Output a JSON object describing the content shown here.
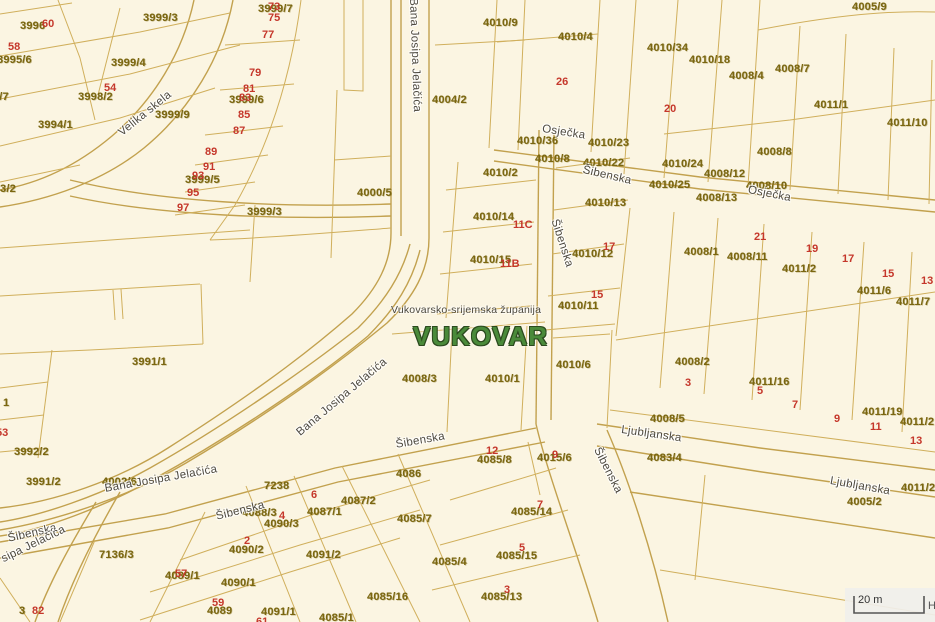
{
  "map": {
    "city_label": "VUKOVAR",
    "county_label": "Vukovarsko-srijemska županija",
    "scale_bar": {
      "label": "20 m",
      "attribution": "H"
    },
    "colors": {
      "background": "#fbf5e2",
      "boundary_line": "#c2a14e",
      "parcel_line": "#d0af5c",
      "parcel_number_text": "#7a6610",
      "house_number_text": "#c5372b",
      "street_name_text": "#4e4a40",
      "city_name_text": "#4a8a3a"
    },
    "legend": {
      "p": "parcel-number",
      "h": "house-number",
      "s": "street-name"
    },
    "labels": [
      {
        "t": "3996",
        "x": 20,
        "y": 21,
        "k": "p"
      },
      {
        "t": "60",
        "x": 42,
        "y": 19,
        "k": "h"
      },
      {
        "t": "3999/3",
        "x": 143,
        "y": 13,
        "k": "p"
      },
      {
        "t": "3999/7",
        "x": 258,
        "y": 4,
        "k": "p"
      },
      {
        "t": "73",
        "x": 268,
        "y": 2,
        "k": "h"
      },
      {
        "t": "75",
        "x": 268,
        "y": 13,
        "k": "h"
      },
      {
        "t": "77",
        "x": 262,
        "y": 30,
        "k": "h"
      },
      {
        "t": "3995/6",
        "x": -3,
        "y": 55,
        "k": "p"
      },
      {
        "t": "3999/4",
        "x": 111,
        "y": 58,
        "k": "p"
      },
      {
        "t": "58",
        "x": 8,
        "y": 42,
        "k": "h"
      },
      {
        "t": "54",
        "x": 104,
        "y": 83,
        "k": "h"
      },
      {
        "t": "3998/2",
        "x": 78,
        "y": 92,
        "k": "p"
      },
      {
        "t": "3998/7",
        "x": -26,
        "y": 92,
        "k": "p"
      },
      {
        "t": "79",
        "x": 249,
        "y": 68,
        "k": "h"
      },
      {
        "t": "81",
        "x": 243,
        "y": 84,
        "k": "h"
      },
      {
        "t": "3999/6",
        "x": 229,
        "y": 95,
        "k": "p"
      },
      {
        "t": "83",
        "x": 239,
        "y": 93,
        "k": "h"
      },
      {
        "t": "85",
        "x": 238,
        "y": 110,
        "k": "h"
      },
      {
        "t": "87",
        "x": 233,
        "y": 126,
        "k": "h"
      },
      {
        "t": "3994/1",
        "x": 38,
        "y": 120,
        "k": "p"
      },
      {
        "t": "3999/9",
        "x": 155,
        "y": 110,
        "k": "p"
      },
      {
        "t": "89",
        "x": 205,
        "y": 147,
        "k": "h"
      },
      {
        "t": "91",
        "x": 203,
        "y": 162,
        "k": "h"
      },
      {
        "t": "3999/5",
        "x": 185,
        "y": 175,
        "k": "p"
      },
      {
        "t": "93",
        "x": 192,
        "y": 171,
        "k": "h"
      },
      {
        "t": "95",
        "x": 187,
        "y": 188,
        "k": "h"
      },
      {
        "t": "97",
        "x": 177,
        "y": 203,
        "k": "h"
      },
      {
        "t": "3/2",
        "x": 0,
        "y": 184,
        "k": "p"
      },
      {
        "t": "3999/3",
        "x": 247,
        "y": 207,
        "k": "p"
      },
      {
        "t": "4000/5",
        "x": 357,
        "y": 188,
        "k": "p"
      },
      {
        "t": "4010/9",
        "x": 483,
        "y": 18,
        "k": "p"
      },
      {
        "t": "4004/2",
        "x": 432,
        "y": 95,
        "k": "p"
      },
      {
        "t": "4010/4",
        "x": 558,
        "y": 32,
        "k": "p"
      },
      {
        "t": "26",
        "x": 556,
        "y": 77,
        "k": "h"
      },
      {
        "t": "4010/36",
        "x": 517,
        "y": 136,
        "k": "p"
      },
      {
        "t": "4010/23",
        "x": 588,
        "y": 138,
        "k": "p"
      },
      {
        "t": "4010/8",
        "x": 535,
        "y": 154,
        "k": "p"
      },
      {
        "t": "4010/22",
        "x": 583,
        "y": 158,
        "k": "p"
      },
      {
        "t": "4010/2",
        "x": 483,
        "y": 168,
        "k": "p"
      },
      {
        "t": "4010/13",
        "x": 585,
        "y": 198,
        "k": "p"
      },
      {
        "t": "4010/14",
        "x": 473,
        "y": 212,
        "k": "p"
      },
      {
        "t": "11C",
        "x": 513,
        "y": 220,
        "k": "h"
      },
      {
        "t": "4010/15",
        "x": 470,
        "y": 255,
        "k": "p"
      },
      {
        "t": "11B",
        "x": 500,
        "y": 259,
        "k": "h"
      },
      {
        "t": "4010/12",
        "x": 572,
        "y": 249,
        "k": "p"
      },
      {
        "t": "17",
        "x": 603,
        "y": 242,
        "k": "h"
      },
      {
        "t": "4010/11",
        "x": 558,
        "y": 301,
        "k": "p"
      },
      {
        "t": "15",
        "x": 591,
        "y": 290,
        "k": "h"
      },
      {
        "t": "4008/3",
        "x": 402,
        "y": 374,
        "k": "p"
      },
      {
        "t": "4010/1",
        "x": 485,
        "y": 374,
        "k": "p"
      },
      {
        "t": "4010/6",
        "x": 556,
        "y": 360,
        "k": "p"
      },
      {
        "t": "3991/1",
        "x": 132,
        "y": 357,
        "k": "p"
      },
      {
        "t": "1",
        "x": 3,
        "y": 398,
        "k": "p"
      },
      {
        "t": "53",
        "x": -4,
        "y": 428,
        "k": "h"
      },
      {
        "t": "3992/2",
        "x": 14,
        "y": 447,
        "k": "p"
      },
      {
        "t": "3991/2",
        "x": 26,
        "y": 477,
        "k": "p"
      },
      {
        "t": "4002/6",
        "x": 102,
        "y": 477,
        "k": "p"
      },
      {
        "t": "7238",
        "x": 264,
        "y": 481,
        "k": "p"
      },
      {
        "t": "7136/3",
        "x": 99,
        "y": 550,
        "k": "p"
      },
      {
        "t": "3",
        "x": 19,
        "y": 606,
        "k": "p"
      },
      {
        "t": "82",
        "x": 32,
        "y": 606,
        "k": "h"
      },
      {
        "t": "4086",
        "x": 396,
        "y": 469,
        "k": "p"
      },
      {
        "t": "6",
        "x": 311,
        "y": 490,
        "k": "h"
      },
      {
        "t": "4087/2",
        "x": 341,
        "y": 496,
        "k": "p"
      },
      {
        "t": "4087/1",
        "x": 307,
        "y": 507,
        "k": "p"
      },
      {
        "t": "4088/3",
        "x": 242,
        "y": 508,
        "k": "p"
      },
      {
        "t": "4",
        "x": 279,
        "y": 511,
        "k": "h"
      },
      {
        "t": "4090/3",
        "x": 264,
        "y": 519,
        "k": "p"
      },
      {
        "t": "2",
        "x": 244,
        "y": 536,
        "k": "h"
      },
      {
        "t": "4090/2",
        "x": 229,
        "y": 545,
        "k": "p"
      },
      {
        "t": "4091/2",
        "x": 306,
        "y": 550,
        "k": "p"
      },
      {
        "t": "4085/7",
        "x": 397,
        "y": 514,
        "k": "p"
      },
      {
        "t": "4085/4",
        "x": 432,
        "y": 557,
        "k": "p"
      },
      {
        "t": "4090/1",
        "x": 221,
        "y": 578,
        "k": "p"
      },
      {
        "t": "4089/1",
        "x": 165,
        "y": 571,
        "k": "p"
      },
      {
        "t": "57",
        "x": 175,
        "y": 569,
        "k": "h"
      },
      {
        "t": "59",
        "x": 212,
        "y": 598,
        "k": "h"
      },
      {
        "t": "4089",
        "x": 207,
        "y": 606,
        "k": "p"
      },
      {
        "t": "4091/1",
        "x": 261,
        "y": 607,
        "k": "p"
      },
      {
        "t": "61",
        "x": 256,
        "y": 617,
        "k": "h"
      },
      {
        "t": "4085/1",
        "x": 319,
        "y": 613,
        "k": "p"
      },
      {
        "t": "4085/16",
        "x": 367,
        "y": 592,
        "k": "p"
      },
      {
        "t": "12",
        "x": 486,
        "y": 446,
        "k": "h"
      },
      {
        "t": "4085/8",
        "x": 477,
        "y": 455,
        "k": "p"
      },
      {
        "t": "4015/6",
        "x": 537,
        "y": 453,
        "k": "p"
      },
      {
        "t": "9",
        "x": 552,
        "y": 450,
        "k": "h"
      },
      {
        "t": "4085/14",
        "x": 511,
        "y": 507,
        "k": "p"
      },
      {
        "t": "7",
        "x": 537,
        "y": 500,
        "k": "h"
      },
      {
        "t": "4085/15",
        "x": 496,
        "y": 551,
        "k": "p"
      },
      {
        "t": "5",
        "x": 519,
        "y": 543,
        "k": "h"
      },
      {
        "t": "4085/13",
        "x": 481,
        "y": 592,
        "k": "p"
      },
      {
        "t": "3",
        "x": 504,
        "y": 585,
        "k": "h"
      },
      {
        "t": "4083/4",
        "x": 647,
        "y": 453,
        "k": "p"
      },
      {
        "t": "4008/5",
        "x": 650,
        "y": 414,
        "k": "p"
      },
      {
        "t": "4008/2",
        "x": 675,
        "y": 357,
        "k": "p"
      },
      {
        "t": "3",
        "x": 685,
        "y": 378,
        "k": "h"
      },
      {
        "t": "4011/16",
        "x": 749,
        "y": 377,
        "k": "p"
      },
      {
        "t": "5",
        "x": 757,
        "y": 386,
        "k": "h"
      },
      {
        "t": "7",
        "x": 792,
        "y": 400,
        "k": "h"
      },
      {
        "t": "9",
        "x": 834,
        "y": 414,
        "k": "h"
      },
      {
        "t": "4011/19",
        "x": 862,
        "y": 407,
        "k": "p"
      },
      {
        "t": "11",
        "x": 870,
        "y": 422,
        "k": "h"
      },
      {
        "t": "4011/2",
        "x": 900,
        "y": 417,
        "k": "p"
      },
      {
        "t": "13",
        "x": 910,
        "y": 436,
        "k": "h"
      },
      {
        "t": "4011/2",
        "x": 901,
        "y": 483,
        "k": "p"
      },
      {
        "t": "4005/2",
        "x": 847,
        "y": 497,
        "k": "p"
      },
      {
        "t": "4010/34",
        "x": 647,
        "y": 43,
        "k": "p"
      },
      {
        "t": "4010/18",
        "x": 689,
        "y": 55,
        "k": "p"
      },
      {
        "t": "4008/4",
        "x": 729,
        "y": 71,
        "k": "p"
      },
      {
        "t": "4008/7",
        "x": 775,
        "y": 64,
        "k": "p"
      },
      {
        "t": "4005/9",
        "x": 852,
        "y": 2,
        "k": "p"
      },
      {
        "t": "4011/1",
        "x": 814,
        "y": 100,
        "k": "p"
      },
      {
        "t": "4011/10",
        "x": 887,
        "y": 118,
        "k": "p"
      },
      {
        "t": "20",
        "x": 664,
        "y": 104,
        "k": "h"
      },
      {
        "t": "4008/8",
        "x": 757,
        "y": 147,
        "k": "p"
      },
      {
        "t": "4010/24",
        "x": 662,
        "y": 159,
        "k": "p"
      },
      {
        "t": "4008/12",
        "x": 704,
        "y": 169,
        "k": "p"
      },
      {
        "t": "4010/25",
        "x": 649,
        "y": 180,
        "k": "p"
      },
      {
        "t": "4008/13",
        "x": 696,
        "y": 193,
        "k": "p"
      },
      {
        "t": "4008/10",
        "x": 746,
        "y": 181,
        "k": "p"
      },
      {
        "t": "4008/1",
        "x": 684,
        "y": 247,
        "k": "p"
      },
      {
        "t": "4008/11",
        "x": 727,
        "y": 252,
        "k": "p"
      },
      {
        "t": "21",
        "x": 754,
        "y": 232,
        "k": "h"
      },
      {
        "t": "4011/2",
        "x": 782,
        "y": 264,
        "k": "p"
      },
      {
        "t": "19",
        "x": 806,
        "y": 244,
        "k": "h"
      },
      {
        "t": "17",
        "x": 842,
        "y": 254,
        "k": "h"
      },
      {
        "t": "4011/6",
        "x": 857,
        "y": 286,
        "k": "p"
      },
      {
        "t": "15",
        "x": 882,
        "y": 269,
        "k": "h"
      },
      {
        "t": "4011/7",
        "x": 896,
        "y": 297,
        "k": "p"
      },
      {
        "t": "13",
        "x": 921,
        "y": 276,
        "k": "h"
      },
      {
        "t": "Velika skela",
        "x": 117,
        "y": 130,
        "k": "s",
        "r": -39
      },
      {
        "t": "Bana Josipa Jelačića",
        "x": 418,
        "y": -2,
        "k": "s",
        "r": 88
      },
      {
        "t": "Osječka",
        "x": 543,
        "y": 124,
        "k": "s",
        "r": 9
      },
      {
        "t": "Šibenska",
        "x": 584,
        "y": 165,
        "k": "s",
        "r": 13
      },
      {
        "t": "Šibenska",
        "x": 559,
        "y": 218,
        "k": "s",
        "r": 72
      },
      {
        "t": "Šibenska",
        "x": 601,
        "y": 446,
        "k": "s",
        "r": 63
      },
      {
        "t": "Osječka",
        "x": 749,
        "y": 185,
        "k": "s",
        "r": 11
      },
      {
        "t": "Ljubljanska",
        "x": 622,
        "y": 425,
        "k": "s",
        "r": 8
      },
      {
        "t": "Ljubljanska",
        "x": 831,
        "y": 476,
        "k": "s",
        "r": 10
      },
      {
        "t": "Šibenska",
        "x": 395,
        "y": 440,
        "k": "s",
        "r": -10
      },
      {
        "t": "Šibenska",
        "x": 215,
        "y": 512,
        "k": "s",
        "r": -14
      },
      {
        "t": "Šibenska",
        "x": 7,
        "y": 534,
        "k": "s",
        "r": -13
      },
      {
        "t": "sipa Jelačića",
        "x": 0,
        "y": 555,
        "k": "s",
        "r": -26
      },
      {
        "t": "Bana Josipa Jelačića",
        "x": 104,
        "y": 484,
        "k": "s",
        "r": -10
      },
      {
        "t": "Bana Josipa Jelačića",
        "x": 295,
        "y": 430,
        "k": "s",
        "r": -40
      }
    ]
  }
}
